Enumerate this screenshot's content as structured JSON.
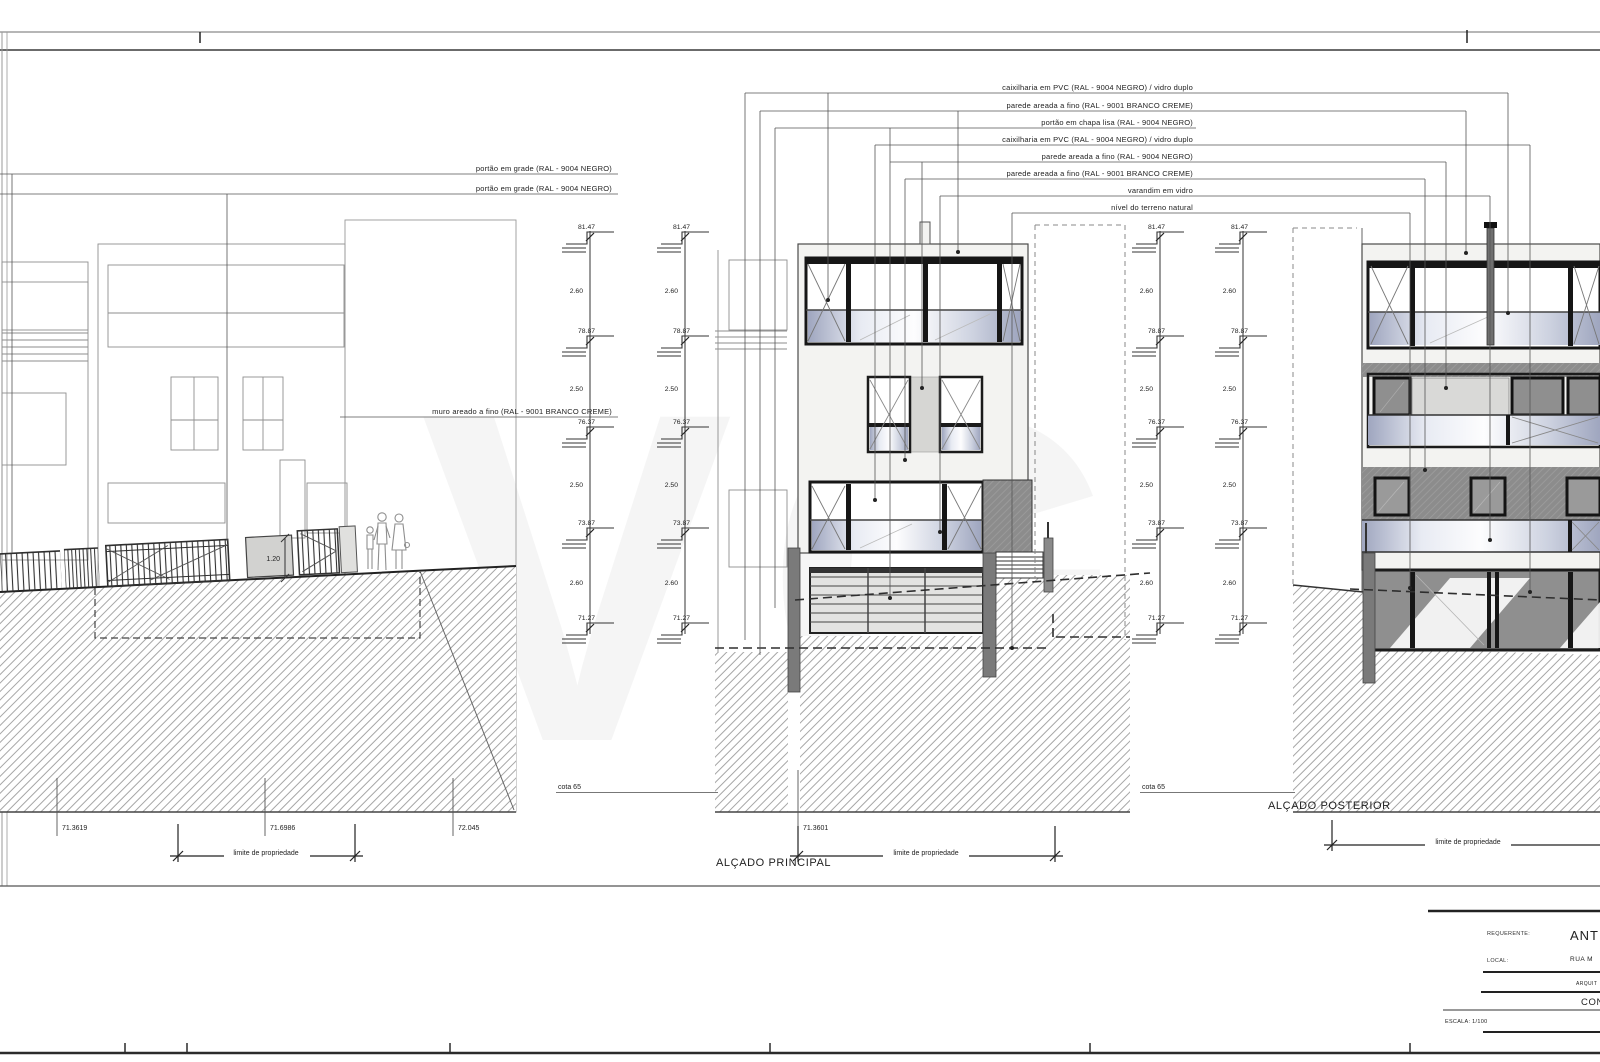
{
  "drawing": {
    "watermark": "VG",
    "titles": {
      "front": "ALÇADO PRINCIPAL",
      "rear": "ALÇADO POSTERIOR"
    },
    "datum_label": "cota 65",
    "property_limit_label": "limite de propriedade",
    "top_labels": [
      "caixilharia em PVC (RAL - 9004 NEGRO) / vidro duplo",
      "parede areada a fino (RAL - 9001 BRANCO CREME)",
      "portão em chapa lisa (RAL - 9004 NEGRO)",
      "caixilharia em PVC (RAL - 9004 NEGRO) / vidro duplo",
      "parede areada a fino (RAL - 9004 NEGRO)",
      "parede areada a fino (RAL - 9001 BRANCO CREME)",
      "varandim em vidro",
      "nível do terreno natural"
    ],
    "left_labels": [
      "portão em grade (RAL - 9004 NEGRO)",
      "portão em grade (RAL - 9004 NEGRO)"
    ],
    "wall_label": "muro areado a fino (RAL - 9001 BRANCO CREME)",
    "gate_height": "1.20",
    "levels": [
      "81.47",
      "78.87",
      "76.37",
      "73.87",
      "71.27"
    ],
    "level_dims": [
      "2.60",
      "2.50",
      "2.50",
      "2.60"
    ],
    "ground_elevations_left": [
      "71.3619",
      "71.6986",
      "72.045"
    ],
    "ground_elevation_front": "71.3601"
  },
  "titleblock": {
    "requerente_label": "REQUERENTE:",
    "requerente_value": "ANT",
    "local_label": "LOCAL:",
    "local_value": "RUA M",
    "arquitetura_fragment": "ARQUIT",
    "construcao_fragment": "CONS",
    "scale": "ESCALA: 1/100"
  },
  "colors": {
    "frame": "#1b1b1b",
    "dark_wall": "#8c8c8c",
    "glass_tint": "#9fa6bf",
    "paper": "#ffffff"
  }
}
